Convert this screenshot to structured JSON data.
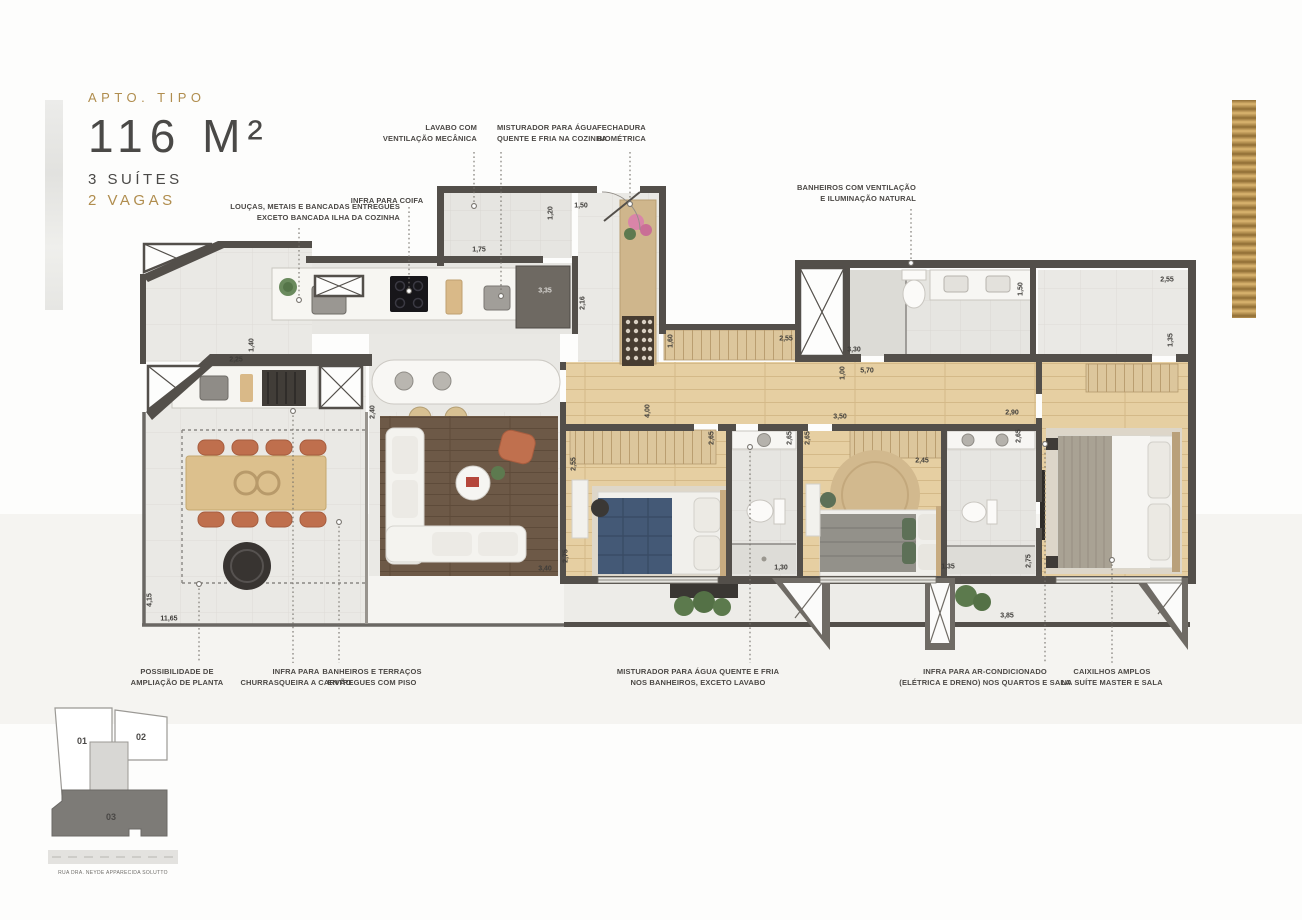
{
  "title": {
    "kicker": "APTO. TIPO",
    "area": "116 M²",
    "suites": "3 SUÍTES",
    "parking": "2 VAGAS"
  },
  "keyplan": {
    "unit01": "01",
    "unit02": "02",
    "unit03": "03",
    "street": "RUA DRA. NEYDE APPARECIDA SOLUTTO"
  },
  "colors": {
    "gold": "#b08d4e",
    "ink": "#4a4947",
    "wall": "#534f4a",
    "wood_floor": "#e6cfa2",
    "tile_floor": "#eae9e5",
    "living_rug": "#6d5947",
    "terracotta_chair": "#bf6f4d",
    "blue_bed": "#445976",
    "green_accent": "#5d7057",
    "highlight_unit": "#7d7b77"
  },
  "callouts_top": [
    {
      "id": "lavabo-ventilacao",
      "lines": [
        "LAVABO COM",
        "VENTILAÇÃO MECÂNICA"
      ],
      "x": 477,
      "y": 123,
      "align": "right",
      "lx": 474,
      "ly1": 152,
      "ly2": 206
    },
    {
      "id": "misturador-cozinha",
      "lines": [
        "MISTURADOR PARA ÁGUA",
        "QUENTE E FRIA NA COZINHA"
      ],
      "x": 497,
      "y": 123,
      "align": "left",
      "lx": 501,
      "ly1": 152,
      "ly2": 296
    },
    {
      "id": "fechadura-biometrica",
      "lines": [
        "FECHADURA",
        "BIOMÉTRICA"
      ],
      "x": 597,
      "y": 123,
      "align": "left",
      "lx": 630,
      "ly1": 152,
      "ly2": 204
    },
    {
      "id": "infra-coifa",
      "lines": [
        "INFRA PARA COIFA"
      ],
      "x": 387,
      "y": 196,
      "align": "center",
      "lx": 409,
      "ly1": 207,
      "ly2": 291
    },
    {
      "id": "loucas-metais",
      "lines": [
        "LOUÇAS, METAIS E BANCADAS ENTREGUES",
        "EXCETO BANCADA ILHA DA COZINHA"
      ],
      "x": 400,
      "y": 202,
      "align": "right",
      "lx": 299,
      "ly1": 228,
      "ly2": 300
    },
    {
      "id": "banheiros-ventilacao",
      "lines": [
        "BANHEIROS COM VENTILAÇÃO",
        "E ILUMINAÇÃO NATURAL"
      ],
      "x": 916,
      "y": 183,
      "align": "right",
      "lx": 911,
      "ly1": 209,
      "ly2": 263
    }
  ],
  "callouts_bottom": [
    {
      "id": "ampliacao-planta",
      "lines": [
        "POSSIBILIDADE DE",
        "AMPLIAÇÃO DE PLANTA"
      ],
      "x": 177,
      "y": 667,
      "lx": 199,
      "ly1": 584,
      "ly2": 663
    },
    {
      "id": "churrasqueira",
      "lines": [
        "INFRA PARA",
        "CHURRASQUEIRA A CARVÃO"
      ],
      "x": 296,
      "y": 667,
      "lx": 293,
      "ly1": 411,
      "ly2": 663
    },
    {
      "id": "pisos-entregues",
      "lines": [
        "BANHEIROS E TERRAÇOS",
        "ENTREGUES COM PISO"
      ],
      "x": 372,
      "y": 667,
      "lx": 339,
      "ly1": 522,
      "ly2": 663
    },
    {
      "id": "misturador-banheiros",
      "lines": [
        "MISTURADOR PARA ÁGUA QUENTE E FRIA",
        "NOS BANHEIROS, EXCETO LAVABO"
      ],
      "x": 698,
      "y": 667,
      "lx": 750,
      "ly1": 447,
      "ly2": 663
    },
    {
      "id": "ar-condicionado",
      "lines": [
        "INFRA PARA AR-CONDICIONADO",
        "(ELÉTRICA E DRENO) NOS QUARTOS E SALA"
      ],
      "x": 985,
      "y": 667,
      "lx": 1045,
      "ly1": 444,
      "ly2": 663
    },
    {
      "id": "caixilhos-amplos",
      "lines": [
        "CAIXILHOS AMPLOS",
        "NA SUÍTE MASTER E SALA"
      ],
      "x": 1112,
      "y": 667,
      "lx": 1112,
      "ly1": 560,
      "ly2": 663
    }
  ],
  "dimensions": [
    {
      "t": "1,50",
      "x": 581,
      "y": 206
    },
    {
      "t": "1,20",
      "x": 551,
      "y": 213,
      "r": 90
    },
    {
      "t": "1,75",
      "x": 479,
      "y": 250
    },
    {
      "t": "3,35",
      "x": 545,
      "y": 291,
      "light": true
    },
    {
      "t": "2,16",
      "x": 583,
      "y": 303,
      "r": 90
    },
    {
      "t": "1,40",
      "x": 252,
      "y": 345,
      "r": 90
    },
    {
      "t": "2,25",
      "x": 236,
      "y": 360
    },
    {
      "t": "1,60",
      "x": 671,
      "y": 341,
      "r": 90
    },
    {
      "t": "2,55",
      "x": 786,
      "y": 339
    },
    {
      "t": "3,30",
      "x": 854,
      "y": 350
    },
    {
      "t": "1,50",
      "x": 1021,
      "y": 289,
      "r": 90
    },
    {
      "t": "2,55",
      "x": 1167,
      "y": 280
    },
    {
      "t": "1,35",
      "x": 1171,
      "y": 340,
      "r": 90
    },
    {
      "t": "4,00",
      "x": 648,
      "y": 411,
      "r": 90
    },
    {
      "t": "1,00",
      "x": 843,
      "y": 373,
      "r": 90
    },
    {
      "t": "5,70",
      "x": 867,
      "y": 371
    },
    {
      "t": "3,50",
      "x": 840,
      "y": 417
    },
    {
      "t": "2,90",
      "x": 1012,
      "y": 413
    },
    {
      "t": "2,65",
      "x": 712,
      "y": 438,
      "r": 90
    },
    {
      "t": "2,65",
      "x": 790,
      "y": 438,
      "r": 90
    },
    {
      "t": "2,65",
      "x": 808,
      "y": 438,
      "r": 90
    },
    {
      "t": "2,45",
      "x": 922,
      "y": 461
    },
    {
      "t": "2,65",
      "x": 1019,
      "y": 436,
      "r": 90
    },
    {
      "t": "2,55",
      "x": 574,
      "y": 464,
      "r": 90
    },
    {
      "t": "2,75",
      "x": 566,
      "y": 556,
      "r": 90
    },
    {
      "t": "3,40",
      "x": 545,
      "y": 569
    },
    {
      "t": "2,40",
      "x": 373,
      "y": 412,
      "r": 90
    },
    {
      "t": "1,30",
      "x": 781,
      "y": 568
    },
    {
      "t": "1,35",
      "x": 948,
      "y": 567
    },
    {
      "t": "2,75",
      "x": 1029,
      "y": 561,
      "r": 90
    },
    {
      "t": "3,85",
      "x": 1007,
      "y": 616
    },
    {
      "t": "4,15",
      "x": 150,
      "y": 600,
      "r": 90
    },
    {
      "t": "11,65",
      "x": 169,
      "y": 619
    }
  ]
}
